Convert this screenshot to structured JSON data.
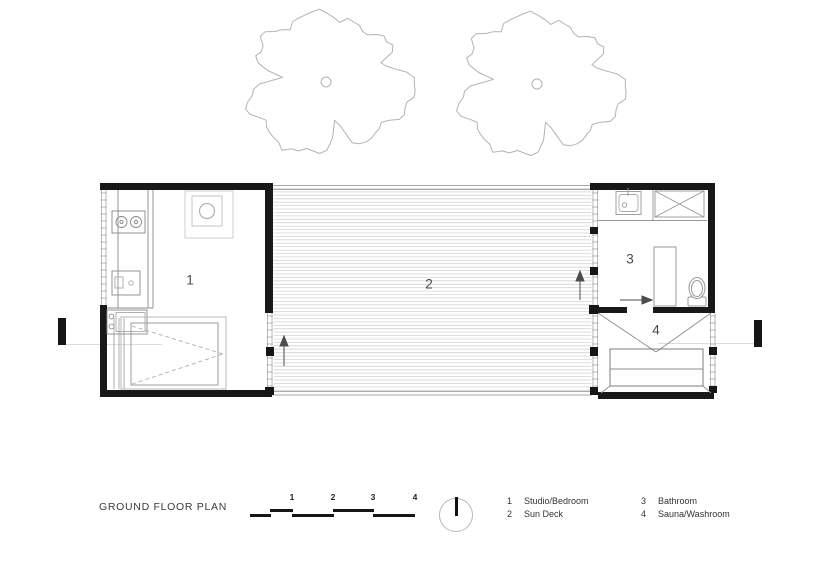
{
  "title": "GROUND FLOOR PLAN",
  "rooms": [
    {
      "number": "1",
      "name": "Studio/Bedroom"
    },
    {
      "number": "2",
      "name": "Sun Deck"
    },
    {
      "number": "3",
      "name": "Bathroom"
    },
    {
      "number": "4",
      "name": "Sauna/Washroom"
    }
  ],
  "scale_bar": {
    "ticks": [
      "1",
      "2",
      "3",
      "4"
    ]
  },
  "colors": {
    "wall": "#181818",
    "thin_line": "#979797",
    "deck_line": "#d4d4d4",
    "tree": "#b3b3b3",
    "text": "#3a3a3a"
  }
}
